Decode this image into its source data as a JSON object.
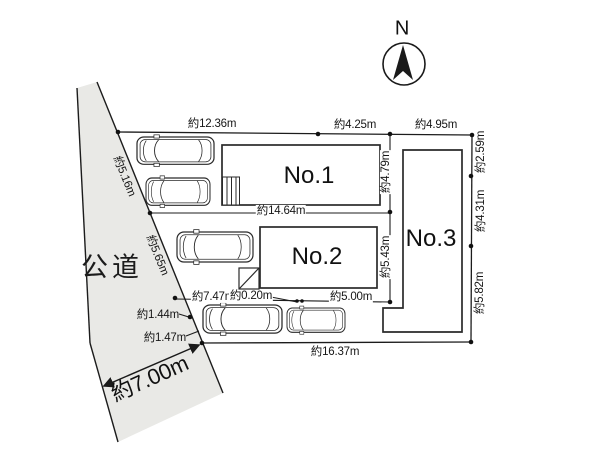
{
  "compass": {
    "label": "N"
  },
  "road": {
    "name": "公道",
    "width_label": "約7.00m"
  },
  "lots": [
    {
      "label": "No.1"
    },
    {
      "label": "No.2"
    },
    {
      "label": "No.3"
    }
  ],
  "dimensions": {
    "top": [
      "約12.36m",
      "約4.25m",
      "約4.95m"
    ],
    "right": [
      "約2.59m",
      "約4.31m",
      "約5.82m"
    ],
    "bottom": "約16.37m",
    "lot1_width": "約14.64m",
    "lot1_depth": "約4.79m",
    "lot2_depth": "約5.43m",
    "frontage_upper": "約5.16m",
    "frontage_lower": "約5.65m",
    "frontage_seg3": "約1.44m",
    "frontage_seg4": "約1.47m",
    "parking_width1": "約7.47m",
    "parking_gap": "約0.20m",
    "parking_width2": "約5.00m"
  }
}
